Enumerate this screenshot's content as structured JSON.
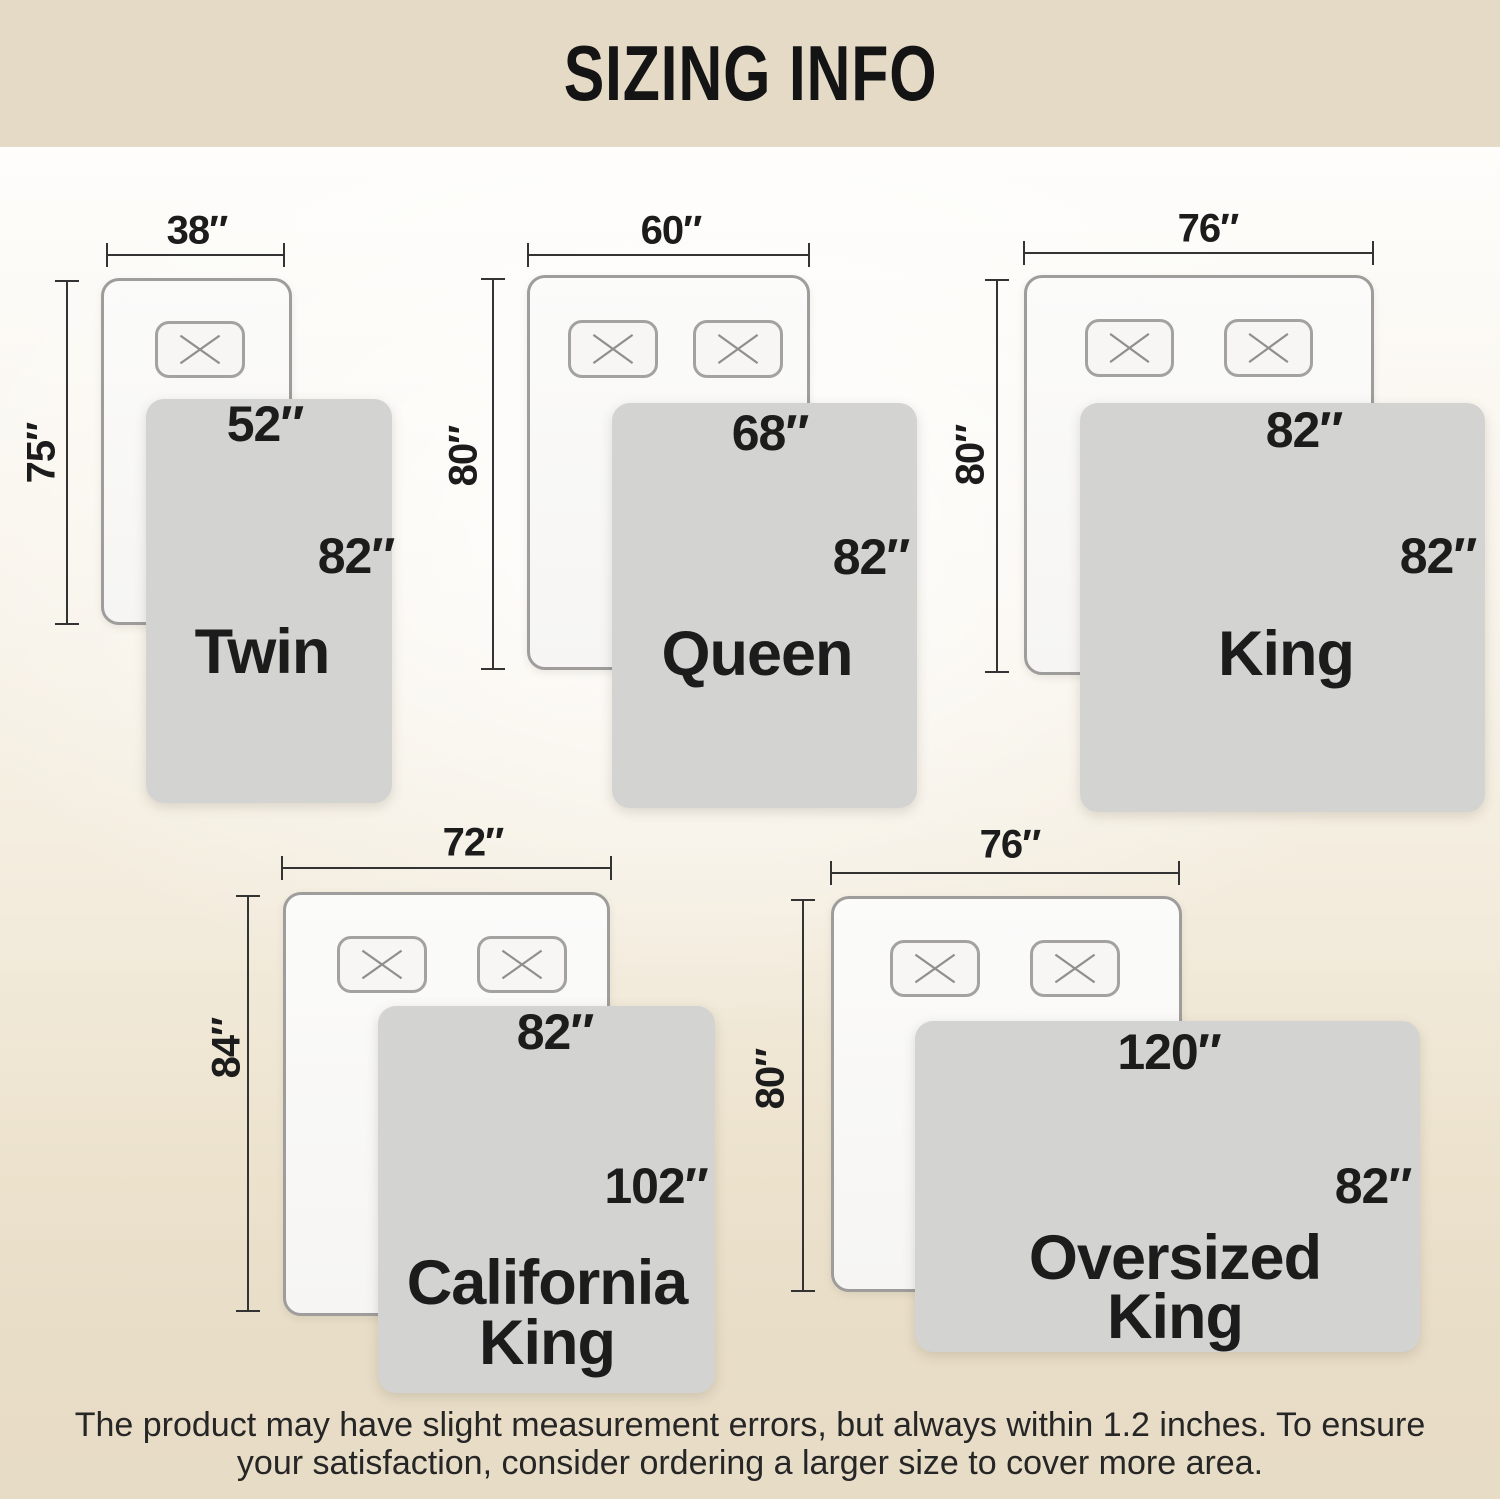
{
  "header": {
    "title": "SIZING INFO"
  },
  "sizes": [
    {
      "name": "Twin",
      "bed_width_label": "38″",
      "bed_height_label": "75″",
      "blanket_top_label": "52″",
      "blanket_side_label": "82″",
      "pillow_count": 1
    },
    {
      "name": "Queen",
      "bed_width_label": "60″",
      "bed_height_label": "80″",
      "blanket_top_label": "68″",
      "blanket_side_label": "82″",
      "pillow_count": 2
    },
    {
      "name": "King",
      "bed_width_label": "76″",
      "bed_height_label": "80″",
      "blanket_top_label": "82″",
      "blanket_side_label": "82″",
      "pillow_count": 2
    },
    {
      "name": "California King",
      "name_line1": "California",
      "name_line2": "King",
      "bed_width_label": "72″",
      "bed_height_label": "84″",
      "blanket_top_label": "82″",
      "blanket_side_label": "102″",
      "pillow_count": 2
    },
    {
      "name": "Oversized King",
      "name_line1": "Oversized",
      "name_line2": "King",
      "bed_width_label": "76″",
      "bed_height_label": "80″",
      "blanket_top_label": "120″",
      "blanket_side_label": "82″",
      "pillow_count": 2
    }
  ],
  "footer": {
    "disclaimer": "The product may have slight measurement errors, but always within 1.2 inches. To ensure your satisfaction, consider ordering a larger size to cover more area."
  },
  "colors": {
    "banner_bg": "#e4dac6",
    "page_bottom": "#e7dcc6",
    "blanket_gray": "#d3d3d1",
    "bed_fill": "#f9f8f6",
    "bed_border": "#9e9d9b",
    "dim_line": "#333333",
    "text": "#1c1c1c"
  }
}
